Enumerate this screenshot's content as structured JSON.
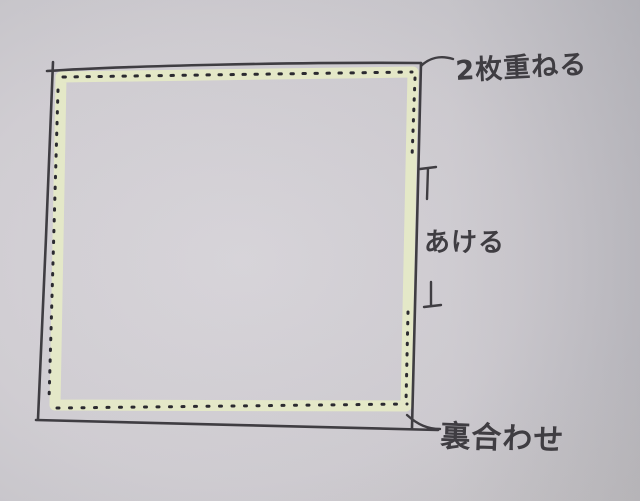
{
  "diagram": {
    "annotations": {
      "stack_two_sheets": "2枚重ねる",
      "leave_open": "あける",
      "wrong_sides_together": "裏合わせ"
    },
    "colors": {
      "paper": "#d0cdd2",
      "ink": "#3f3d42",
      "stitch_dots": "#2b2a30",
      "highlight": "#e7ecc6"
    }
  }
}
